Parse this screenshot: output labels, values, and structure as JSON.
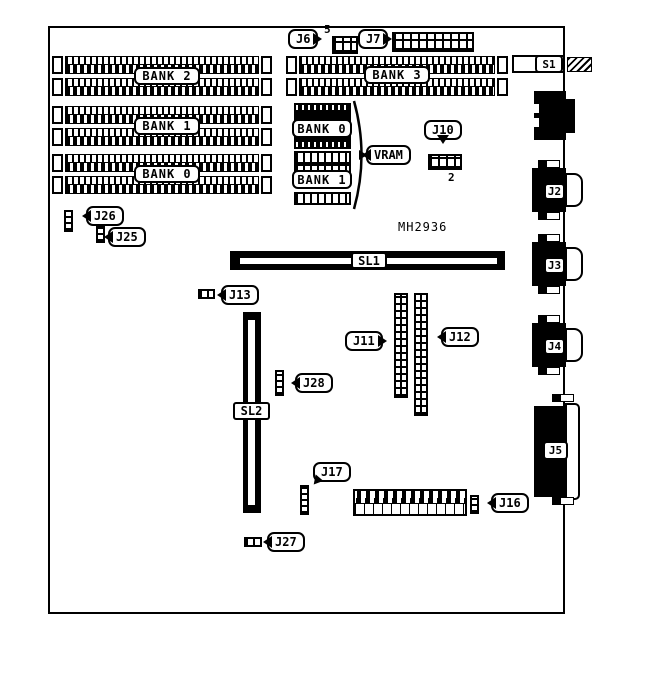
{
  "diagram": {
    "board_id": "MH2936",
    "simm_banks_left": [
      {
        "label": "BANK 2"
      },
      {
        "label": "BANK 1"
      },
      {
        "label": "BANK 0"
      }
    ],
    "simm_bank_right": {
      "label": "BANK 3"
    },
    "vram_group": {
      "brace_label": "VRAM",
      "bank_top": "BANK 0",
      "bank_bottom": "BANK 1"
    },
    "slots": {
      "sl1": "SL1",
      "sl2": "SL2"
    },
    "callouts": {
      "j6": {
        "label": "J6",
        "pin_label": "5"
      },
      "j7": {
        "label": "J7"
      },
      "j10": {
        "label": "J10",
        "pin_label": "2"
      },
      "j11": {
        "label": "J11"
      },
      "j12": {
        "label": "J12"
      },
      "j13": {
        "label": "J13"
      },
      "j16": {
        "label": "J16"
      },
      "j17": {
        "label": "J17"
      },
      "j25": {
        "label": "J25"
      },
      "j26": {
        "label": "J26"
      },
      "j27": {
        "label": "J27"
      },
      "j28": {
        "label": "J28"
      }
    },
    "rear_ports": {
      "s1": "S1",
      "j2": "J2",
      "j3": "J3",
      "j4": "J4",
      "j5": "J5"
    }
  }
}
